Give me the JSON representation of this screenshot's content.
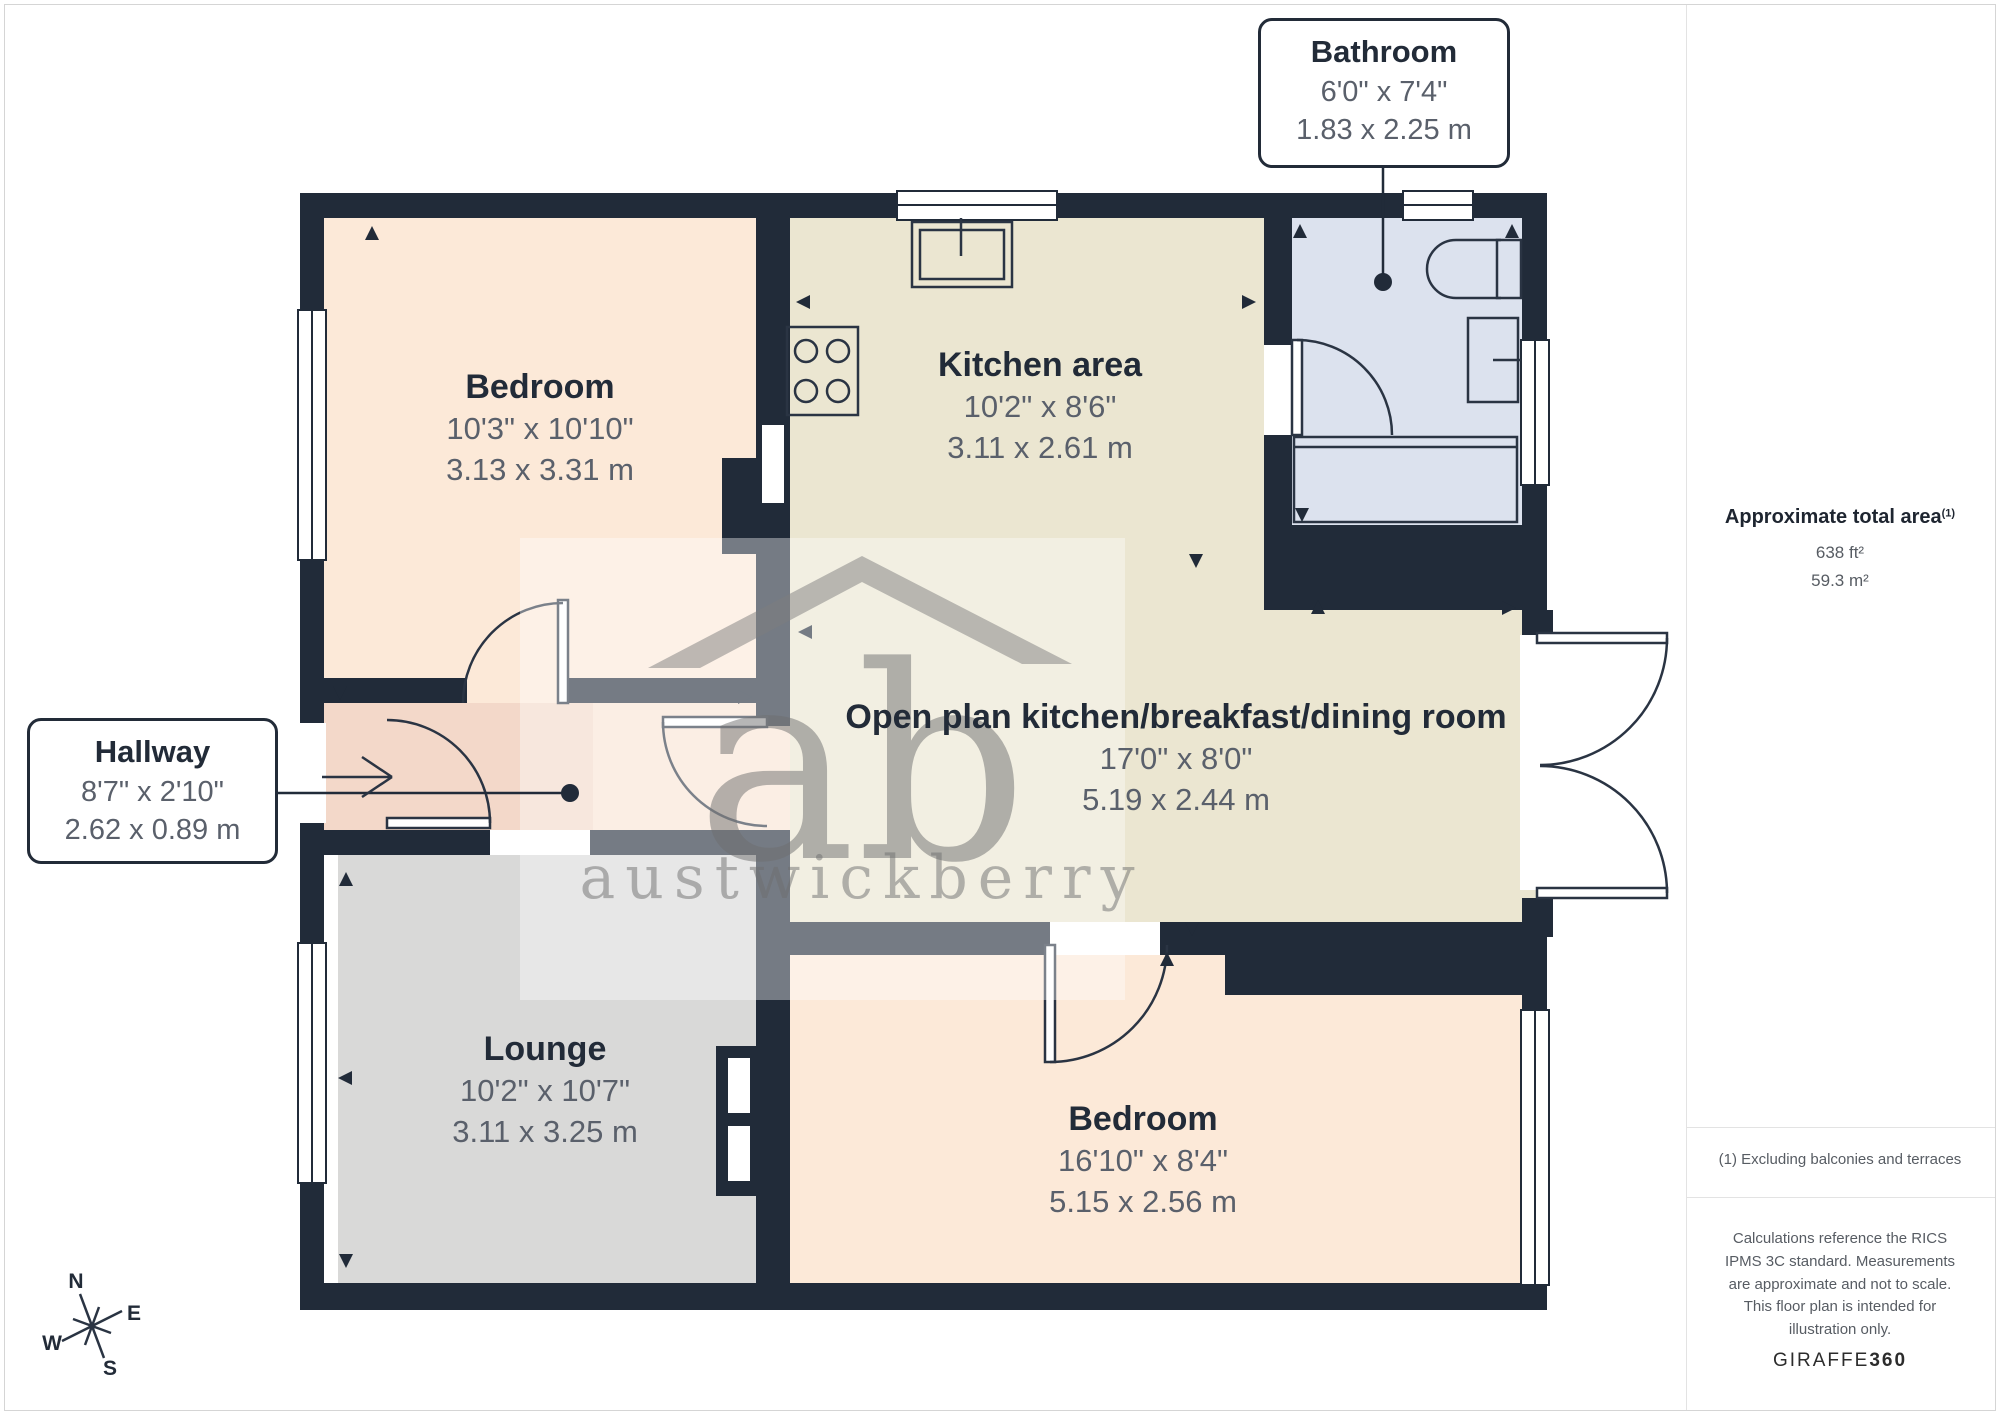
{
  "rooms": {
    "bedroom1": {
      "name": "Bedroom",
      "imperial": "10'3\" x 10'10\"",
      "metric": "3.13 x 3.31 m"
    },
    "kitchen": {
      "name": "Kitchen area",
      "imperial": "10'2\" x 8'6\"",
      "metric": "3.11 x 2.61 m"
    },
    "openplan": {
      "name": "Open plan kitchen/breakfast/dining room",
      "imperial": "17'0\" x 8'0\"",
      "metric": "5.19 x 2.44 m"
    },
    "lounge": {
      "name": "Lounge",
      "imperial": "10'2\" x 10'7\"",
      "metric": "3.11 x 3.25 m"
    },
    "bedroom2": {
      "name": "Bedroom",
      "imperial": "16'10\" x 8'4\"",
      "metric": "5.15 x 2.56 m"
    }
  },
  "callouts": {
    "bathroom": {
      "name": "Bathroom",
      "imperial": "6'0\" x 7'4\"",
      "metric": "1.83 x 2.25 m"
    },
    "hallway": {
      "name": "Hallway",
      "imperial": "8'7\" x 2'10\"",
      "metric": "2.62 x 0.89 m"
    }
  },
  "sidebar": {
    "total_area_title": "Approximate total area",
    "total_area_note_ref": "(1)",
    "area_ft": "638 ft²",
    "area_m": "59.3 m²",
    "footnote": "(1) Excluding balconies and terraces",
    "disclaimer": "Calculations reference the RICS IPMS 3C standard. Measurements are approximate and not to scale. This floor plan is intended for illustration only.",
    "brand": "GIRAFFE",
    "brand_bold": "360"
  },
  "compass": {
    "n": "N",
    "e": "E",
    "s": "S",
    "w": "W"
  },
  "watermark": {
    "initials": "ab",
    "name": "austwickberry"
  },
  "colors": {
    "wall": "#212b39",
    "bedroom": "#fce9d8",
    "kitchen_openplan": "#ebe6d1",
    "bathroom": "#dce2ee",
    "hallway": "#f3d8c9",
    "corridor": "#f9e4d4",
    "lounge": "#d9d9d8",
    "label_dark": "#222b38",
    "label_gray": "#5a606b"
  }
}
